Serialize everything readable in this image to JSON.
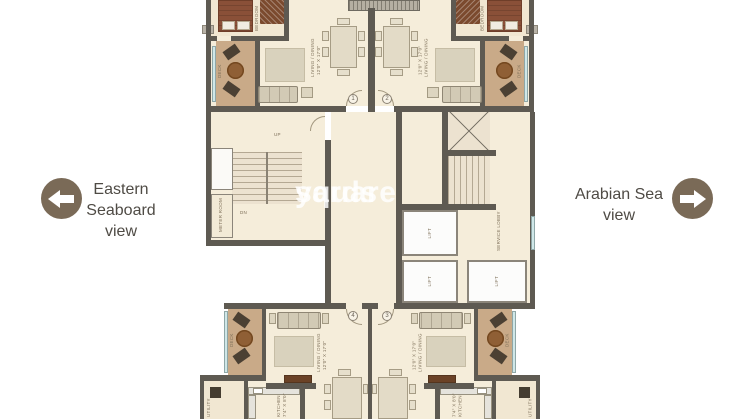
{
  "view_labels": {
    "left": {
      "lines": [
        "Eastern",
        "Seaboard",
        "view"
      ]
    },
    "right": {
      "lines": [
        "Arabian Sea",
        "view"
      ]
    }
  },
  "watermark": {
    "line1": "square",
    "line2": "yards"
  },
  "plan": {
    "rooms": {
      "living_dining": "LIVING / DINING",
      "living_dims": "12'0\" X 17'0\"",
      "deck": "DECK",
      "deck_dims": "8'0\" X 12'4\"",
      "bedroom": "BEDROOM",
      "kitchen": "KITCHEN",
      "kitchen_dims": "7'4\" X 8'0\"",
      "utility": "UTILITY",
      "lift": "LIFT",
      "service_lobby": "SERVICE LOBBY",
      "meter_room": "METER ROOM",
      "up": "UP",
      "dn": "DN"
    },
    "units": {
      "u1": "1",
      "u2": "2",
      "u3": "3",
      "u4": "4"
    }
  },
  "colors": {
    "wall": "#5e5a52",
    "floor": "#f5edda",
    "deck": "#c9aa88",
    "accent_circle": "#7a6a57",
    "label_text": "#4f4b45",
    "watermark": "#ffffff"
  }
}
